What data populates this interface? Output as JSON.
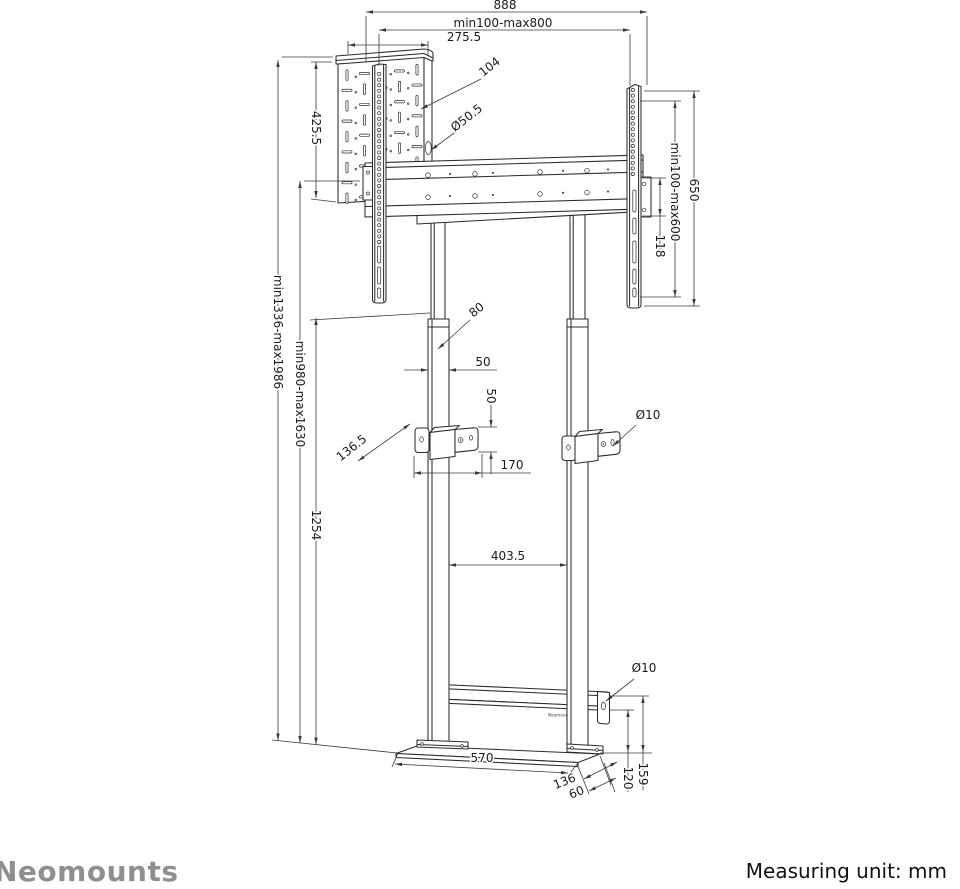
{
  "branding": {
    "logo": "Neomounts",
    "bar_label": "Neomounts"
  },
  "footer": {
    "unit_label": "Measuring unit: mm"
  },
  "colors": {
    "line": "#2b2b2b",
    "dim": "#3a3a3a",
    "logo": "#8f8f8f",
    "text": "#1a1a1a"
  },
  "dims": {
    "width_total": "888",
    "width_vesa": "min100-max800",
    "width_box": "275.5",
    "slot": "104",
    "grommet": "Ø50.5",
    "box_height": "425.5",
    "rail_height": "650",
    "vesa_height": "min100-max600",
    "beam_end": "118",
    "height_total": "min1336-max1986",
    "height_col": "min980-max1630",
    "col_fixed": "1254",
    "col_depth": "80",
    "col_width": "50",
    "clamp_h": "50",
    "wall_gap": "136.5",
    "clamp_w": "170",
    "hole_mid": "Ø10",
    "col_gap": "403.5",
    "hole_base": "Ø10",
    "base_w": "570",
    "base_d": "136",
    "base_off": "60",
    "bar_h": "120",
    "tab_h": "159"
  }
}
